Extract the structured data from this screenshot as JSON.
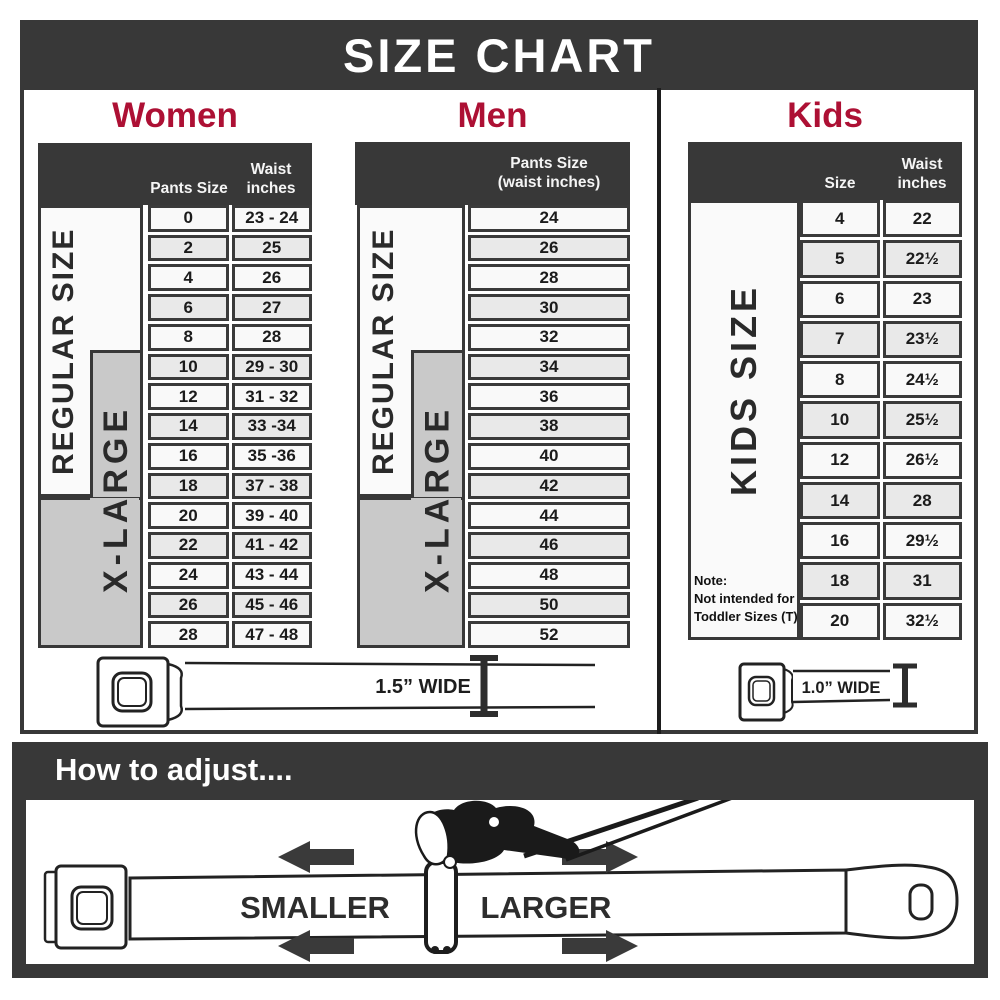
{
  "header": {
    "title": "SIZE CHART"
  },
  "panels": {
    "women": {
      "title": "Women",
      "columns": {
        "pants": "Pants Size",
        "waist_line1": "Waist",
        "waist_line2": "inches"
      },
      "regular_label": "REGULAR SIZE",
      "xlarge_label": "X-LARGE",
      "rows": [
        {
          "size": "0",
          "waist": "23 - 24"
        },
        {
          "size": "2",
          "waist": "25"
        },
        {
          "size": "4",
          "waist": "26"
        },
        {
          "size": "6",
          "waist": "27"
        },
        {
          "size": "8",
          "waist": "28"
        },
        {
          "size": "10",
          "waist": "29 - 30"
        },
        {
          "size": "12",
          "waist": "31 - 32"
        },
        {
          "size": "14",
          "waist": "33 -34"
        },
        {
          "size": "16",
          "waist": "35 -36"
        },
        {
          "size": "18",
          "waist": "37 - 38"
        },
        {
          "size": "20",
          "waist": "39 - 40"
        },
        {
          "size": "22",
          "waist": "41 - 42"
        },
        {
          "size": "24",
          "waist": "43 - 44"
        },
        {
          "size": "26",
          "waist": "45 - 46"
        },
        {
          "size": "28",
          "waist": "47 - 48"
        }
      ],
      "belt_width_label": "1.5” WIDE"
    },
    "men": {
      "title": "Men",
      "column_line1": "Pants Size",
      "column_line2": "(waist inches)",
      "regular_label": "REGULAR SIZE",
      "xlarge_label": "X-LARGE",
      "rows": [
        "24",
        "26",
        "28",
        "30",
        "32",
        "34",
        "36",
        "38",
        "40",
        "42",
        "44",
        "46",
        "48",
        "50",
        "52"
      ]
    },
    "kids": {
      "title": "Kids",
      "columns": {
        "size": "Size",
        "waist_line1": "Waist",
        "waist_line2": "inches"
      },
      "side_label": "KIDS SIZE",
      "note_line1": "Note:",
      "note_line2": "Not intended for",
      "note_line3": "Toddler Sizes (T)",
      "rows": [
        {
          "size": "4",
          "waist": "22"
        },
        {
          "size": "5",
          "waist": "22½"
        },
        {
          "size": "6",
          "waist": "23"
        },
        {
          "size": "7",
          "waist": "23½"
        },
        {
          "size": "8",
          "waist": "24½"
        },
        {
          "size": "10",
          "waist": "25½"
        },
        {
          "size": "12",
          "waist": "26½"
        },
        {
          "size": "14",
          "waist": "28"
        },
        {
          "size": "16",
          "waist": "29½"
        },
        {
          "size": "18",
          "waist": "31"
        },
        {
          "size": "20",
          "waist": "32½"
        }
      ],
      "belt_width_label": "1.0” WIDE"
    }
  },
  "adjust": {
    "title": "How to adjust....",
    "smaller": "SMALLER",
    "larger": "LARGER"
  },
  "colors": {
    "dark": "#383838",
    "accent_red": "#ad1034",
    "group_gray": "#c9c9c9",
    "row_light": "#f9f9f9",
    "row_alt": "#e9e9e9"
  },
  "chart_data": [
    {
      "type": "table",
      "title": "Women",
      "columns": [
        "Pants Size",
        "Waist inches"
      ],
      "rows": [
        [
          "0",
          "23 - 24"
        ],
        [
          "2",
          "25"
        ],
        [
          "4",
          "26"
        ],
        [
          "6",
          "27"
        ],
        [
          "8",
          "28"
        ],
        [
          "10",
          "29 - 30"
        ],
        [
          "12",
          "31 - 32"
        ],
        [
          "14",
          "33 -34"
        ],
        [
          "16",
          "35 -36"
        ],
        [
          "18",
          "37 - 38"
        ],
        [
          "20",
          "39 - 40"
        ],
        [
          "22",
          "41 - 42"
        ],
        [
          "24",
          "43 - 44"
        ],
        [
          "26",
          "45 - 46"
        ],
        [
          "28",
          "47 - 48"
        ]
      ],
      "groups": {
        "REGULAR SIZE": "pants sizes 0-18",
        "X-LARGE": "pants sizes 10-28"
      },
      "belt_width": "1.5” WIDE"
    },
    {
      "type": "table",
      "title": "Men",
      "columns": [
        "Pants Size (waist inches)"
      ],
      "rows": [
        [
          "24"
        ],
        [
          "26"
        ],
        [
          "28"
        ],
        [
          "30"
        ],
        [
          "32"
        ],
        [
          "34"
        ],
        [
          "36"
        ],
        [
          "38"
        ],
        [
          "40"
        ],
        [
          "42"
        ],
        [
          "44"
        ],
        [
          "46"
        ],
        [
          "48"
        ],
        [
          "50"
        ],
        [
          "52"
        ]
      ],
      "groups": {
        "REGULAR SIZE": "sizes 24-42",
        "X-LARGE": "sizes 34-52"
      },
      "belt_width": "1.5” WIDE"
    },
    {
      "type": "table",
      "title": "Kids",
      "columns": [
        "Size",
        "Waist inches"
      ],
      "rows": [
        [
          "4",
          "22"
        ],
        [
          "5",
          "22½"
        ],
        [
          "6",
          "23"
        ],
        [
          "7",
          "23½"
        ],
        [
          "8",
          "24½"
        ],
        [
          "10",
          "25½"
        ],
        [
          "12",
          "26½"
        ],
        [
          "14",
          "28"
        ],
        [
          "16",
          "29½"
        ],
        [
          "18",
          "31"
        ],
        [
          "20",
          "32½"
        ]
      ],
      "groups": {
        "KIDS SIZE": "sizes 4-20"
      },
      "note": "Not intended for Toddler Sizes (T)",
      "belt_width": "1.0” WIDE"
    }
  ]
}
